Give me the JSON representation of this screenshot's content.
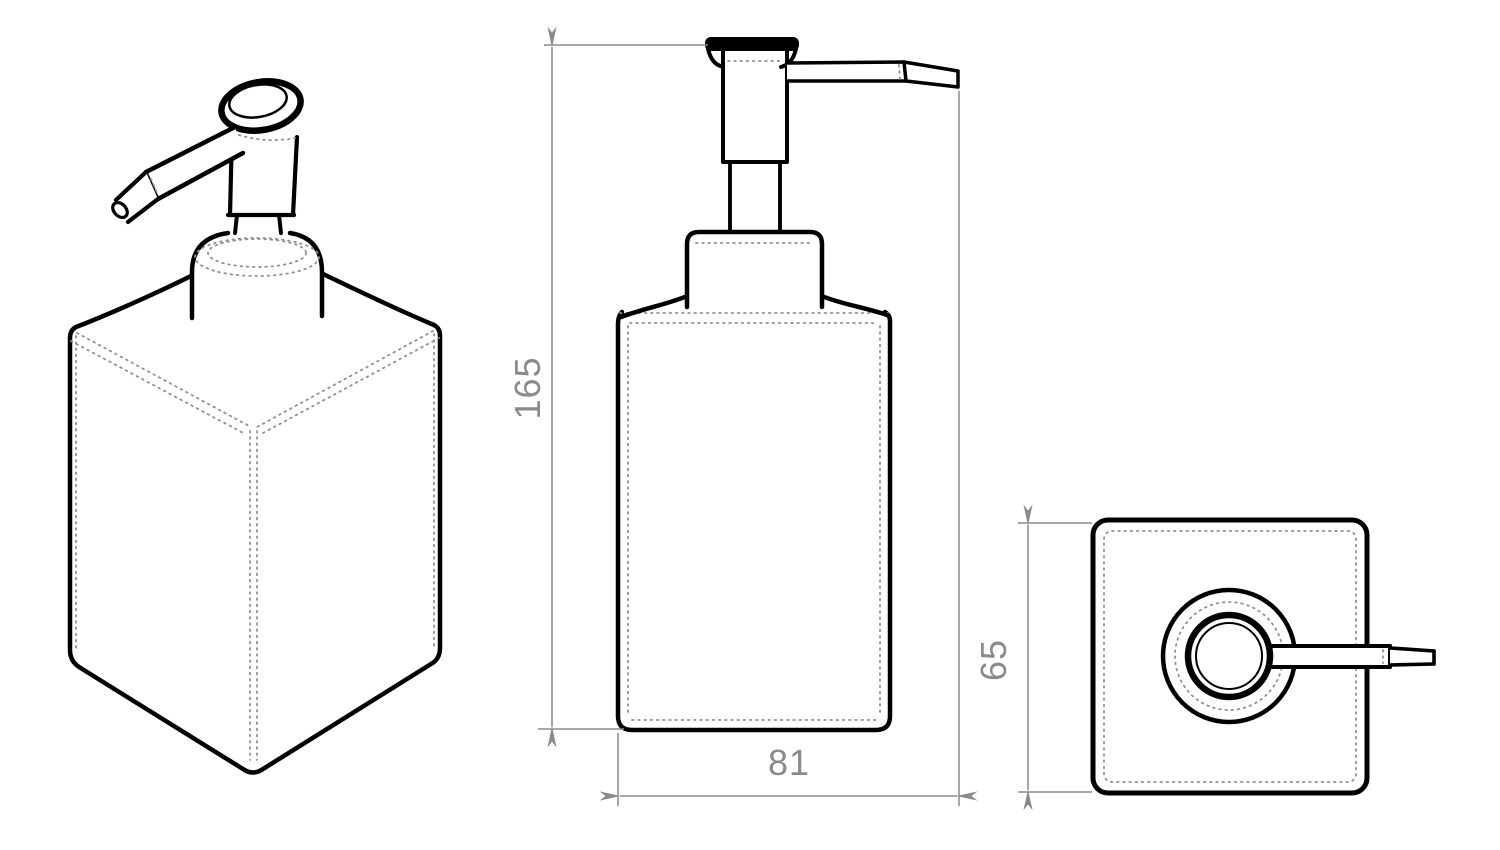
{
  "drawing": {
    "background_color": "#ffffff",
    "outline_color": "#000000",
    "dimension_color": "#8a8a8a",
    "dotted_color": "#909090",
    "dimensions": {
      "height": "165",
      "overall_width": "81",
      "depth": "65"
    }
  }
}
